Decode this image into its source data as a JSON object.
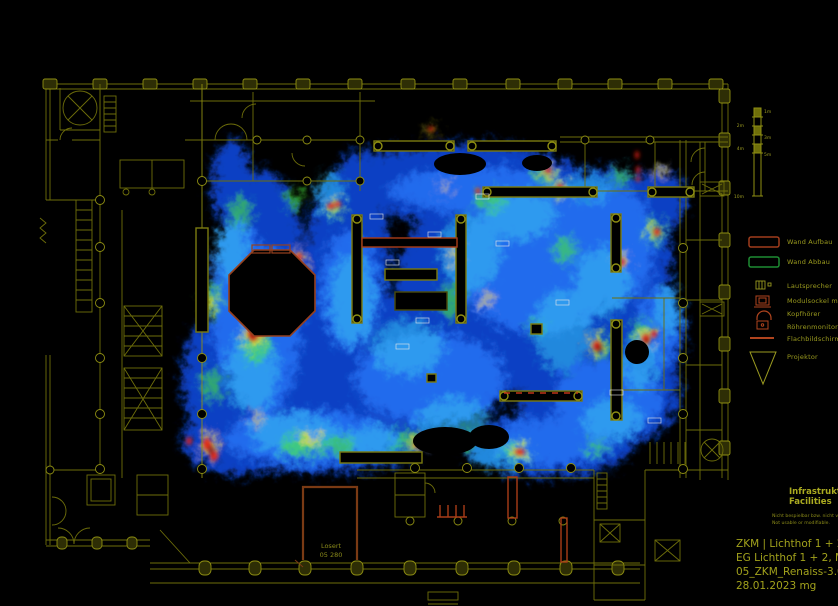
{
  "title_block": {
    "section_de": "Infrastruktur",
    "section_en": "Facilities",
    "note_de": "Nicht bespielbar bzw. nicht veränderbar.",
    "note_en": "Not usable or modifiable.",
    "line1": "ZKM | Lichthof 1 + 2",
    "line2": "EG Lichthof 1 + 2, M 1:250",
    "line3": "05_ZKM_Renaiss-3.0_E01",
    "line4": "28.01.2023 mg"
  },
  "legend": {
    "items": [
      {
        "label": "Wand Aufbau",
        "icon": "wall-buildup-icon",
        "color": "#a03c1c"
      },
      {
        "label": "Wand Abbau",
        "icon": "wall-removal-icon",
        "color": "#1e8c32"
      },
      {
        "label": "Lautsprecher",
        "icon": "speaker-icon",
        "color": "#9a9a20"
      },
      {
        "label": "Modulsockel mit Monitor",
        "icon": "module-pedestal-monitor-icon",
        "color": "#b0441e"
      },
      {
        "label": "Kopfhörer",
        "icon": "headphones-icon",
        "color": "#b0441e"
      },
      {
        "label": "Röhrenmonitor mit Sockel",
        "icon": "crt-monitor-icon",
        "color": "#b0441e"
      },
      {
        "label": "Flachbildschirm",
        "icon": "flatscreen-icon",
        "color": "#b0441e"
      },
      {
        "label": "Projektor",
        "icon": "projector-icon",
        "color": "#9a9a20"
      }
    ]
  },
  "scale_bar": {
    "labels": [
      "1m",
      "2m",
      "3m",
      "4m",
      "5m",
      "10m"
    ]
  },
  "plan": {
    "room_label": {
      "line1": "Losert",
      "line2": "05 280"
    }
  },
  "colors": {
    "background": "#000000",
    "plan_line": "#70700a",
    "plan_line_bright": "#8f8f12",
    "heat_blue": "#1050e8",
    "heat_cyan": "#38c2f2",
    "heat_green": "#46e83c",
    "heat_yellow": "#f2e02a",
    "heat_red": "#e81e10",
    "wall_buildup_red": "#a03c1c",
    "wall_removal_green": "#1e8c32"
  }
}
